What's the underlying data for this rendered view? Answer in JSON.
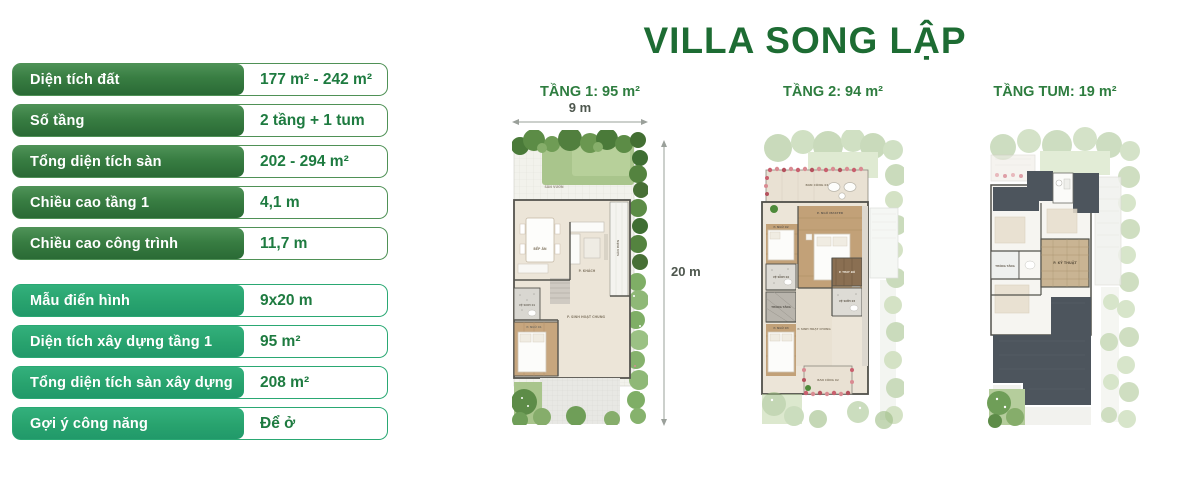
{
  "title": "VILLA SONG LẬP",
  "colors": {
    "title_green": "#1d6c33",
    "label_gradient_dark": "#2a6a35",
    "label_gradient_teal": "#28a36e",
    "value_text": "#1e7b40",
    "plan_label": "#2e7d3f"
  },
  "specs": {
    "group1": [
      {
        "label": "Diện tích đất",
        "value": "177 m² - 242 m²"
      },
      {
        "label": "Số tầng",
        "value": "2 tầng + 1 tum"
      },
      {
        "label": "Tổng diện tích sàn",
        "value": "202 - 294 m²"
      },
      {
        "label": "Chiều cao tầng 1",
        "value": "4,1 m"
      },
      {
        "label": "Chiều cao công trình",
        "value": "11,7 m"
      }
    ],
    "group2": [
      {
        "label": "Mẫu điển hình",
        "value": "9x20 m"
      },
      {
        "label": "Diện tích xây dựng tầng 1",
        "value": "95 m²"
      },
      {
        "label": "Tổng diện tích sàn xây dựng",
        "value": "208 m²"
      },
      {
        "label": "Gợi ý công năng",
        "value": "Để ở"
      }
    ]
  },
  "dimensions": {
    "width": "9 m",
    "depth": "20 m"
  },
  "plans": [
    {
      "name": "TẦNG 1: 95 m²",
      "rooms": {
        "garden": "SÂN VƯỜN",
        "porch": "SÂN HIÊN",
        "kitchen": "BẾP ĂN",
        "living": "P. KHÁCH",
        "common": "P. SINH HOẠT CHUNG",
        "wc": "VỆ SINH 01",
        "bedroom": "P. NGỦ 01"
      }
    },
    {
      "name": "TẦNG 2: 94 m²",
      "rooms": {
        "balcony1": "BAN CÔNG 01",
        "master": "P. NGỦ MASTER",
        "bedroom2": "P. NGỦ 02",
        "bathroom2": "VỆ SINH 02",
        "closet": "P. THAY ĐỒ",
        "bathroom3": "VỆ SINH 03",
        "void": "THÔNG TẦNG",
        "bedroom3": "P. NGỦ 03",
        "common": "P. SINH HOẠT CHUNG",
        "balcony2": "BAN CÔNG 02"
      }
    },
    {
      "name": "TẦNG TUM: 19 m²",
      "rooms": {
        "void": "THÔNG TẦNG",
        "technical": "P. KỸ THUẬT"
      }
    }
  ]
}
